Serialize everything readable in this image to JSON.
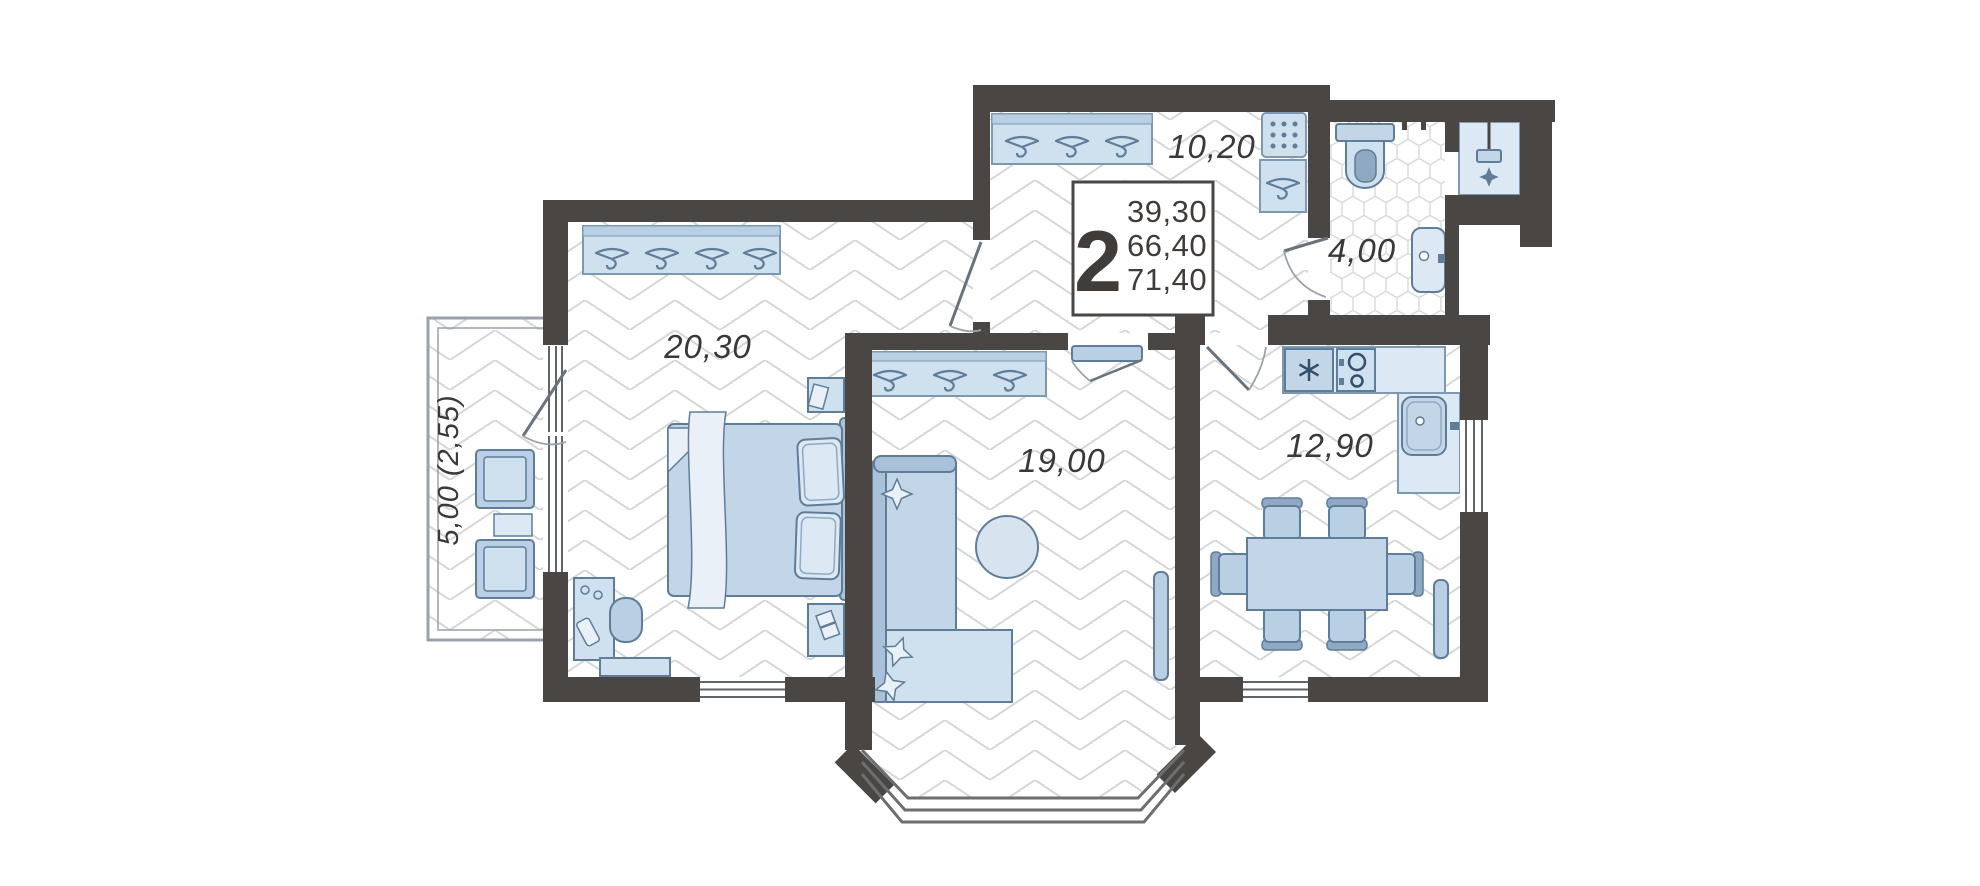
{
  "title": "2-room apartment floor plan",
  "unit_info": {
    "room_count": "2",
    "area_living": "39,30",
    "area_total": "66,40",
    "area_overall": "71,40"
  },
  "rooms": [
    {
      "id": "hallway",
      "label": "10,20"
    },
    {
      "id": "bathroom",
      "label": "4,00"
    },
    {
      "id": "bedroom",
      "label": "20,30"
    },
    {
      "id": "living-room",
      "label": "19,00"
    },
    {
      "id": "kitchen",
      "label": "12,90"
    },
    {
      "id": "balcony",
      "label": "5,00 (2,55)"
    }
  ],
  "colors": {
    "wall": "#4a4643",
    "furniture": "#c3d6e8",
    "furniture_light": "#cfe0ee",
    "furniture_pale": "#e9f0f7",
    "outline": "#5f7d99",
    "floor_line": "#d5d8db",
    "label_text": "#3b3937"
  }
}
